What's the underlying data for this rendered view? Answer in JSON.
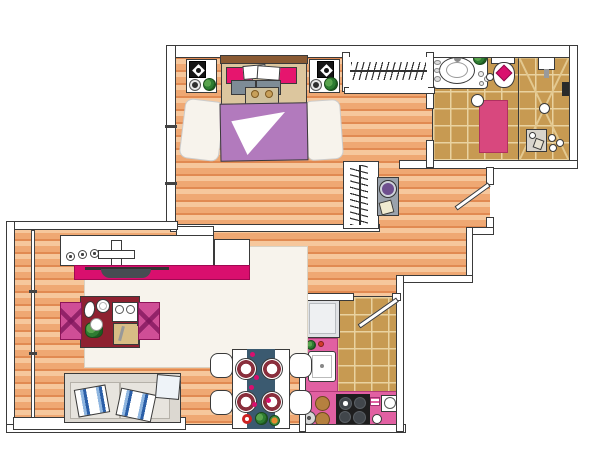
{
  "title": "Apartment floor plan illustration",
  "colors": {
    "outline": "#3a3a3a",
    "wall_fill": "#ffffff",
    "wood_light": "#f6c79c",
    "wood_mid": "#efa873",
    "wood_dark": "#e18a52",
    "tile": "#c79a52",
    "tile_grout": "#e9d2a0",
    "magenta": "#d90f6e",
    "pink": "#e160a2",
    "chairpink": "#cf4e96",
    "crimson": "#e6156e",
    "duvet": "#b27abd",
    "maroon": "#8e2130",
    "teal": "#3b5a70",
    "sofa": "#dcd8d1",
    "cushion": "#e7e4de",
    "gray_pillow": "#7e8c96",
    "bed_tan": "#dcc69e",
    "headboard": "#8a5a33",
    "blanket": "#cfc09b",
    "washer": "#9aa2ac",
    "washer_door": "#6e4f8e",
    "fridge": "#e0e2e5",
    "stove": "#1e1e1e",
    "brown": "#b5803f",
    "mat": "#d8487e",
    "rug": "#f7f3ec"
  },
  "rooms": {
    "bedroom": {
      "label": "Bedroom",
      "furniture": [
        "double-bed",
        "headboard",
        "magenta-pillows",
        "white-pillows",
        "gray-pillows",
        "folded-blanket",
        "teddy-bears",
        "purple-duvet",
        "bedside-rug-left",
        "bedside-rug-right",
        "nightstand-left",
        "nightstand-right",
        "table-lamp-left",
        "table-lamp-right",
        "alarm-clock-left",
        "alarm-clock-right",
        "plant-left",
        "plant-right"
      ]
    },
    "wardrobe": {
      "label": "Wardrobe closet",
      "furniture": [
        "hanging-rail",
        "clothes-hangers"
      ]
    },
    "bathroom": {
      "label": "Bathroom",
      "furniture": [
        "vanity",
        "sink-basin",
        "soaps",
        "plant",
        "toiletries",
        "toilet",
        "toilet-towel",
        "toilet-paper",
        "bath-mat",
        "stool",
        "shower",
        "shower-head",
        "shower-drain",
        "shower-controls",
        "tray",
        "bottles"
      ]
    },
    "hallway": {
      "label": "Hallway",
      "furniture": [
        "tall-closet",
        "clothes-hangers",
        "washing-machine",
        "detergent-box"
      ]
    },
    "living": {
      "label": "Living / dining room",
      "furniture": [
        "media-sideboard",
        "knobs",
        "hifi-unit",
        "cabinet",
        "tv-bench",
        "tv",
        "area-rug",
        "dining-table",
        "oval-plate",
        "round-plate",
        "flower-centerpiece",
        "glass-tray",
        "cutting-board",
        "napkin",
        "dining-chair-left",
        "dining-chair-right",
        "sofa",
        "seat-cushions",
        "striped-pillow-left",
        "striped-pillow-right",
        "arm-pillow",
        "breakfast-table",
        "table-runner",
        "plates",
        "petal-dots",
        "flowers",
        "breakfast-chairs"
      ]
    },
    "kitchen": {
      "label": "Kitchen",
      "furniture": [
        "fridge",
        "counter",
        "sink",
        "faucet",
        "flowers",
        "stools",
        "grinder",
        "cooktop",
        "potholder",
        "second-sink",
        "small-bowl"
      ]
    },
    "balcony": {
      "label": "Balcony window",
      "furniture": [
        "glass-wall",
        "window-band"
      ]
    }
  },
  "doors": {
    "entry": {
      "label": "Entry door"
    },
    "kitchen": {
      "label": "Kitchen door"
    },
    "bathroom": {
      "label": "Bathroom doorway"
    }
  }
}
